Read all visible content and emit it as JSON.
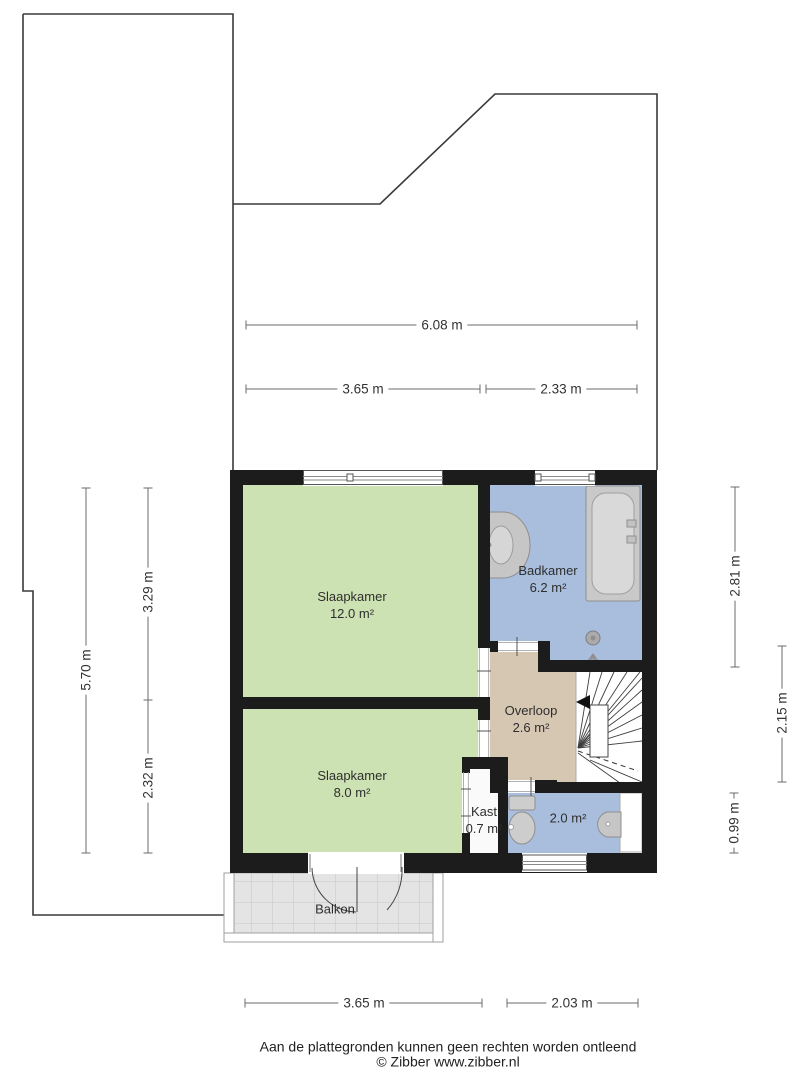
{
  "rooms": {
    "bedroom_large": {
      "name": "Slaapkamer",
      "area": "12.0 m²"
    },
    "bathroom": {
      "name": "Badkamer",
      "area": "6.2 m²"
    },
    "landing": {
      "name": "Overloop",
      "area": "2.6 m²"
    },
    "bedroom_small": {
      "name": "Slaapkamer",
      "area": "8.0 m²"
    },
    "closet": {
      "name": "Kast",
      "area": "0.7 m²"
    },
    "toilet": {
      "area": "2.0 m²"
    },
    "balcony": {
      "name": "Balkon"
    }
  },
  "dimensions": {
    "top_total": "6.08 m",
    "top_left": "3.65 m",
    "top_right": "2.33 m",
    "left_total": "5.70 m",
    "left_upper": "3.29 m",
    "left_lower": "2.32 m",
    "right_upper": "2.81 m",
    "right_middle": "2.15 m",
    "right_lower": "0.99 m",
    "bottom_left": "3.65 m",
    "bottom_right": "2.03 m"
  },
  "footer": {
    "disclaimer": "Aan de plattegronden kunnen geen rechten worden ontleend",
    "credit": "© Zibber www.zibber.nl"
  },
  "colors": {
    "wall": "#1c1c1c",
    "bedroom_fill": "#cde2b3",
    "bathroom_fill": "#a9bedd",
    "landing_fill": "#d6c7b2",
    "closet_fill": "#fafafa",
    "tile_fill": "#e4e4e4",
    "fixture_fill": "#c9c9c9",
    "contour_line": "#3a3a3a",
    "dimension_line": "#6b6b6b"
  }
}
